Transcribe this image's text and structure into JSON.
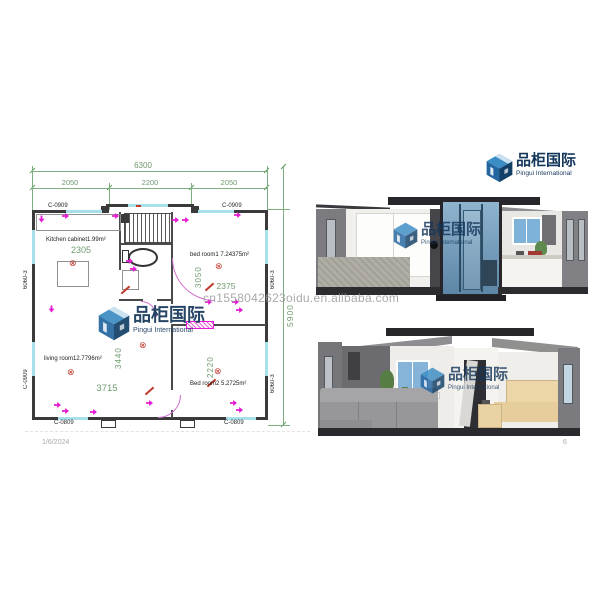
{
  "meta": {
    "date": "1/6/2024",
    "page_number": "6"
  },
  "watermark": {
    "url": "cn1558042623oidu.en.alibaba.com"
  },
  "logo": {
    "cn": "品柜国际",
    "en": "Pingui International",
    "monogram": "PG"
  },
  "floor_plan": {
    "dim_total_width": "6300",
    "dim_segments": [
      "2050",
      "2200",
      "2050"
    ],
    "dim_total_height": "5900",
    "dim_kitchen_width": "2305",
    "dim_bed1_height": "3050",
    "dim_bed1_width": "2375",
    "dim_living_height": "3440",
    "dim_living_width": "3715",
    "dim_bed2_height": "2220",
    "room_kitchen": "Kitchen cabinet1.99m²",
    "room_bed1": "bed room1  7.24375m²",
    "room_living": "living room12.7796m²",
    "room_bed2": "Bed room2  5.2725m²",
    "code_top_left": "C-0909",
    "code_top_right": "C-0909",
    "code_bottom_left": "C-0809",
    "code_bottom_right": "C-0809",
    "code_left_upper": "6060-3",
    "code_left_lower": "C-0909",
    "code_right_upper": "6060-3",
    "code_right_lower": "6060-3"
  },
  "colors": {
    "dimension_green": "#6f9a6f",
    "wall_black": "#3a3a3a",
    "window_cyan": "#a6e0ea",
    "fixture_magenta": "#e61ad4",
    "symbol_red": "#c0392b",
    "logo_navy": "#14365a",
    "logo_blue": "#3b8cc4",
    "glass_blue": "#7fa9c9",
    "bed_beige": "#e6cd9c",
    "watermark_gray": "#9b9b9b"
  }
}
